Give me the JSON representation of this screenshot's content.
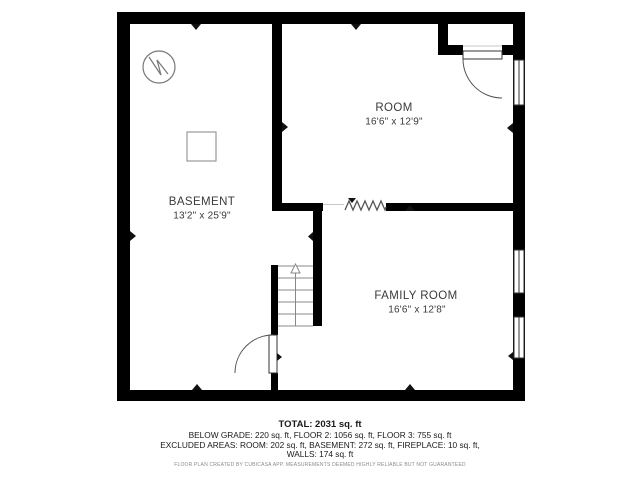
{
  "page": {
    "background": "#ffffff",
    "type_label": "basement floor plan"
  },
  "floorplan": {
    "rooms": [
      {
        "name": "BASEMENT",
        "dimensions": "13'2\" x 25'9\""
      },
      {
        "name": "ROOM",
        "dimensions": "16'6\" x 12'9\""
      },
      {
        "name": "FAMILY ROOM",
        "dimensions": "16'6\" x 12'8\""
      }
    ],
    "symbols": [
      "electrical-panel-symbol",
      "column-square-symbol",
      "stairs-up",
      "fireplace-zigzag",
      "door-swing-closet",
      "door-swing-basement",
      "window-room-right",
      "window-family-room-upper",
      "window-family-room-lower"
    ],
    "colors": {
      "wall": "#000000",
      "thin_line": "#777777",
      "opening_line": "#c8c8c8",
      "label_text": "#3a3a3a",
      "footer_text": "#1a1a1a",
      "disclaimer_text": "#8a8a8a"
    }
  },
  "footer": {
    "total": "TOTAL: 2031 sq. ft",
    "area_line_1": "BELOW GRADE: 220 sq. ft, FLOOR 2: 1056 sq. ft, FLOOR 3: 755 sq. ft",
    "area_line_2": "EXCLUDED AREAS: ROOM: 202 sq. ft, BASEMENT: 272 sq. ft, FIREPLACE: 10 sq. ft,",
    "area_line_3": "WALLS: 174 sq. ft",
    "disclaimer": "FLOOR PLAN CREATED BY CUBICASA APP. MEASUREMENTS DEEMED HIGHLY RELIABLE BUT NOT GUARANTEED"
  }
}
